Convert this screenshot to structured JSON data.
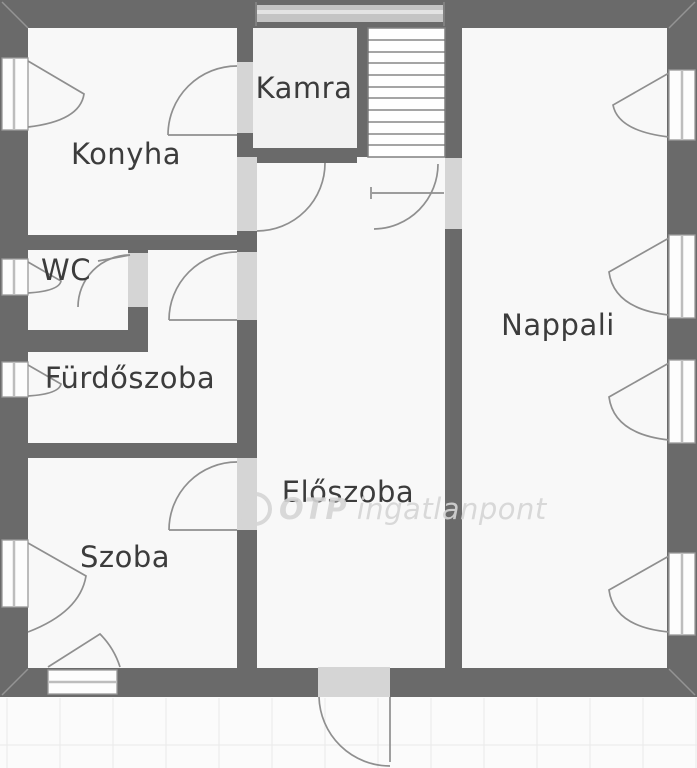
{
  "rooms": {
    "konyha": {
      "label": "Konyha"
    },
    "kamra": {
      "label": "Kamra"
    },
    "wc": {
      "label": "WC"
    },
    "furdoszoba": {
      "label": "Fürdőszoba"
    },
    "szoba": {
      "label": "Szoba"
    },
    "eloszoba": {
      "label": "Előszoba"
    },
    "nappali": {
      "label": "Nappali"
    }
  },
  "watermark": {
    "brand": "OTP",
    "suffix": "ingatlanpont"
  },
  "stairs": {
    "tread_count": 10
  },
  "colors": {
    "wall": "#6a6a6a",
    "floor": "#f8f8f8",
    "pantry_floor": "#f2f2f2",
    "door_opening": "#d5d5d5",
    "symbol_line": "#8f8f8f",
    "label_text": "#3c3c3c",
    "watermark": "#d5d5d5",
    "terrace": "#fbfbfb",
    "terrace_grid": "#ececec"
  }
}
